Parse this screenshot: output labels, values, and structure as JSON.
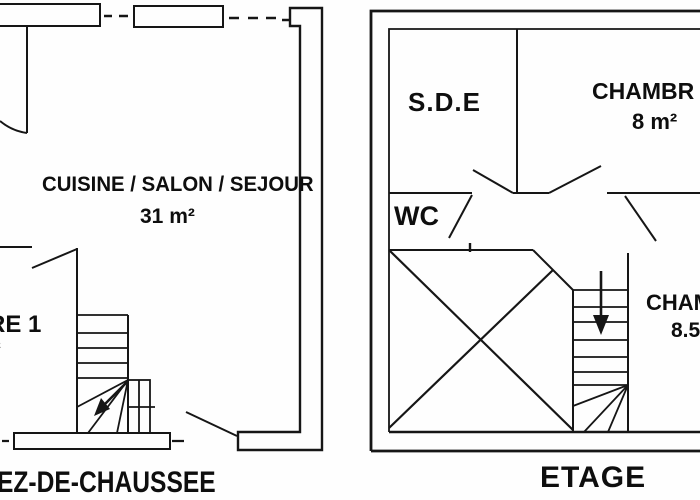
{
  "page": {
    "background": "#fefefe",
    "line_color": "#161616",
    "text_color": "#0e0e0e"
  },
  "ground_floor": {
    "title": "EZ-DE-CHAUSSEE",
    "living_room": {
      "label": "CUISINE / SALON / SEJOUR",
      "area": "31 m²"
    },
    "bedroom1": {
      "label_fragment": "RE 1",
      "area_fragment": "²"
    },
    "stairs_arrow_direction": "up-left"
  },
  "upper_floor": {
    "title": "ETAGE",
    "shower_room": {
      "label": "S.D.E"
    },
    "bedroom2": {
      "label_fragment": "CHAMBR",
      "area": "8 m²"
    },
    "wc": {
      "label": "WC"
    },
    "bedroom3": {
      "label_fragment": "CHAM",
      "area_fragment": "8.5"
    },
    "stairs_arrow_direction": "down"
  }
}
